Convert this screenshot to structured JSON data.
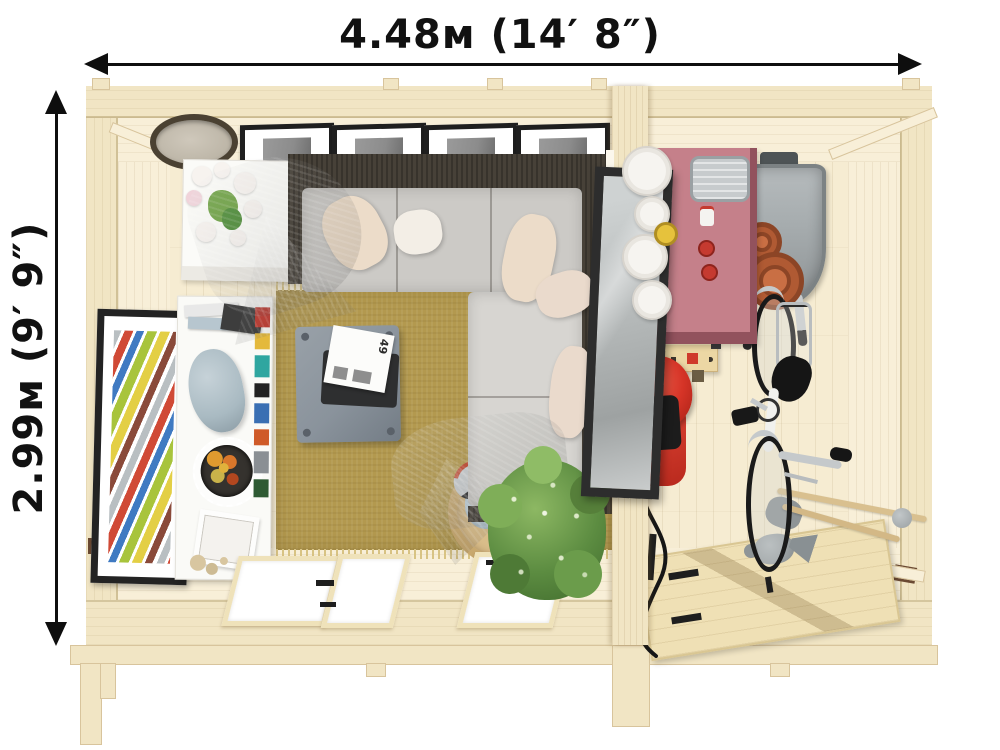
{
  "dimension_labels": {
    "width": "4.48м (14′ 8″)",
    "height": "2.99м (9′ 9″)"
  },
  "magazine": {
    "page_number": "49"
  },
  "scene": {
    "view": "top-down cutaway render of a two-room garden log cabin",
    "rooms": [
      {
        "name": "living-room",
        "items": [
          "wall-clock",
          "gallery-picture-frames",
          "console-table-with-flowers",
          "corner-sofa",
          "cushions",
          "wool-blanket",
          "grey-throw",
          "leaning-wall-mirror",
          "abstract-wall-art",
          "white-bookshelf",
          "jute-rug",
          "coffee-table",
          "magazine",
          "wicker-basket",
          "potted-plant",
          "glazed-double-doors",
          "window"
        ]
      },
      {
        "name": "garage-storage",
        "items": [
          "potting-table",
          "white-plant-pots",
          "metal-tray",
          "wheelbarrow",
          "terracotta-pots",
          "workbench",
          "red-power-tool",
          "bicycle",
          "watering-can",
          "garden-tool-handles",
          "ledged-wooden-door"
        ]
      }
    ]
  },
  "colors": {
    "wood_floor": "#f6ecd2",
    "wood_wall": "#f1e5c4",
    "wood_face": "#f8efd8",
    "wood_edge": "#d8c49c",
    "rug": "#b3994f",
    "rug_fringe": "#d8c383",
    "sofa_frame": "#474138",
    "cushion": "#cccac6",
    "cushion_light": "#d7d5d1",
    "pillow_cream": "#ecdcc9",
    "pillow_white": "#f3eee6",
    "pillow_blush": "#eadacc",
    "blanket": "#8b7f6b",
    "throw": "#a9a092",
    "coffee_table": "#8a939c",
    "tray": "#2e2f30",
    "magazine": "#fcfcfa",
    "mirror_frame": "#2d2d2d",
    "mirror_glass": "#b9bdbd",
    "art_frame": "#232323",
    "shelf_white": "#fafaf7",
    "vase": "#a9bac2",
    "basket": "#c8a86e",
    "basket_cloth": "#c0d3dd",
    "basket_handle": "#c04a33",
    "plant": "#5c8c41",
    "plant_dark": "#3f6a2c",
    "plant_light": "#8db863",
    "pink_table": "#c5808a",
    "pink_edge": "#92525d",
    "metal": "#c7cbcd",
    "metal_dark": "#9aa0a3",
    "barrow": "#a7adaf",
    "barrow_dark": "#7c8284",
    "terracotta": "#b05a33",
    "terracotta_dark": "#8c4526",
    "terracotta_light": "#c96f44",
    "bench": "#ecd7a4",
    "bench_band": "#f4e5ba",
    "accent_red": "#cf3a2b",
    "dots": "#3c362e",
    "tool_red": "#d63427",
    "tool_dark": "#1c1c1c",
    "bike_dark": "#1a1a1a",
    "bike_silver": "#c5c9cb",
    "bike_white": "#f1f1ee",
    "bike_blue": "#2e9fd4",
    "door_wood": "#efe0b5",
    "door_line": "#d9c693",
    "hardware": "#1e1e1e",
    "knob": "#9aa0a2",
    "arrow": "#0e0e0e",
    "text": "#111111",
    "glass": "#ffffff",
    "frame_black": "#1f1f1f",
    "photo": "#8c8c8c",
    "clock_rim": "#4a4132",
    "clock_face": "#cfc8bb",
    "flower_white": "#f7f3ef",
    "flower_green": "#6fa245"
  }
}
